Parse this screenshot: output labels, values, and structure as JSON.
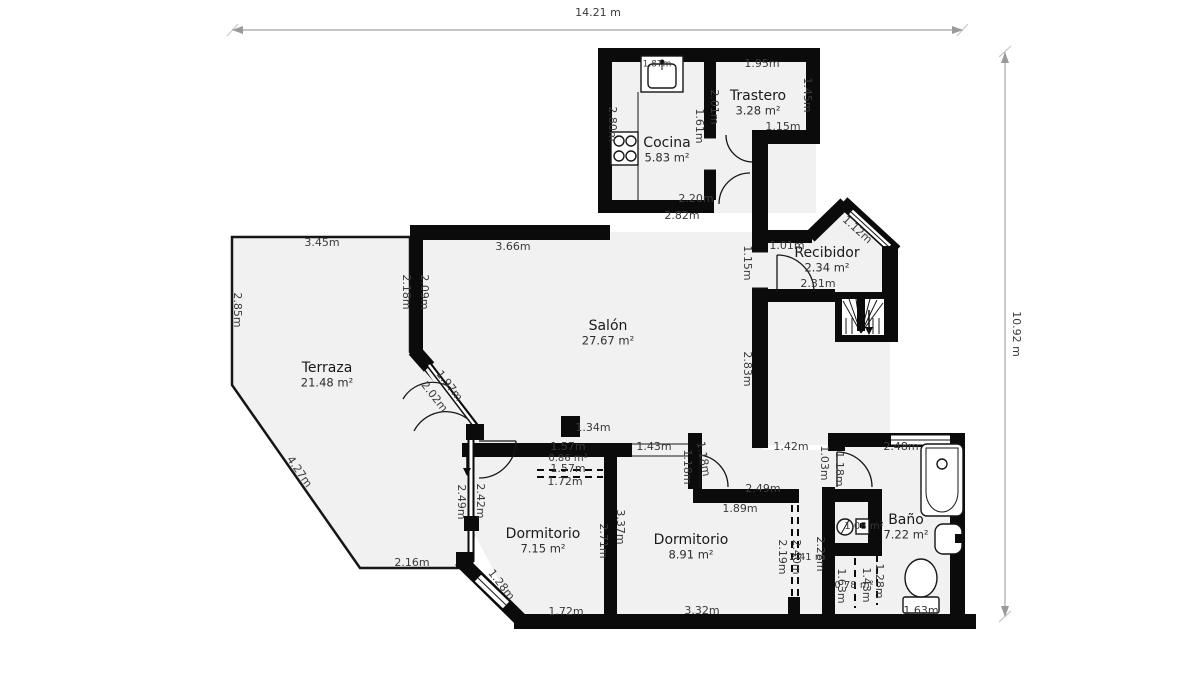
{
  "meta": {
    "plan_total_width": "14.21 m",
    "plan_total_height": "10.92 m",
    "colors": {
      "wall": "#0b0b0b",
      "room_fill": "#f1f1f1",
      "background": "#ffffff",
      "dim_text": "#3a3a3a",
      "dim_line": "#b3b3b3"
    }
  },
  "rooms": [
    {
      "name": "Cocina",
      "area": "5.83 m²",
      "x": 667,
      "y": 143
    },
    {
      "name": "Trastero",
      "area": "3.28 m²",
      "x": 758,
      "y": 96
    },
    {
      "name": "Recibidor",
      "area": "2.34 m²",
      "x": 827,
      "y": 253
    },
    {
      "name": "Salón",
      "area": "27.67 m²",
      "x": 608,
      "y": 326
    },
    {
      "name": "Terraza",
      "area": "21.48 m²",
      "x": 327,
      "y": 368
    },
    {
      "name": "Dormitorio",
      "area": "7.15 m²",
      "x": 543,
      "y": 534
    },
    {
      "name": "Dormitorio",
      "area": "8.91 m²",
      "x": 691,
      "y": 540
    },
    {
      "name": "Baño",
      "area": "7.22 m²",
      "x": 906,
      "y": 520
    }
  ],
  "labels": [
    {
      "t": "14.21 m",
      "x": 598,
      "y": 13,
      "r": 0,
      "s": 11
    },
    {
      "t": "10.92 m",
      "x": 1016,
      "y": 334,
      "r": 90,
      "s": 11
    },
    {
      "t": "1.87m",
      "x": 657,
      "y": 64,
      "r": 0,
      "s": 9
    },
    {
      "t": "1.95m",
      "x": 762,
      "y": 64,
      "r": 0,
      "s": 11
    },
    {
      "t": "1.45m",
      "x": 807,
      "y": 95,
      "r": 90,
      "s": 11
    },
    {
      "t": "1.15m",
      "x": 783,
      "y": 127,
      "r": 0,
      "s": 11
    },
    {
      "t": "2.01m",
      "x": 714,
      "y": 107,
      "r": 90,
      "s": 11
    },
    {
      "t": "1.61m",
      "x": 699,
      "y": 126,
      "r": 90,
      "s": 11
    },
    {
      "t": "2.80m",
      "x": 612,
      "y": 124,
      "r": 90,
      "s": 11
    },
    {
      "t": "2.20m",
      "x": 696,
      "y": 199,
      "r": 0,
      "s": 11
    },
    {
      "t": "2.82m",
      "x": 682,
      "y": 216,
      "r": 0,
      "s": 11
    },
    {
      "t": "1.01m",
      "x": 787,
      "y": 246,
      "r": 0,
      "s": 11
    },
    {
      "t": "1.12m",
      "x": 857,
      "y": 230,
      "r": 42,
      "s": 11
    },
    {
      "t": "2.31m",
      "x": 818,
      "y": 284,
      "r": 0,
      "s": 11
    },
    {
      "t": "1.15m",
      "x": 747,
      "y": 263,
      "r": 90,
      "s": 11
    },
    {
      "t": "2.83m",
      "x": 747,
      "y": 369,
      "r": 90,
      "s": 11
    },
    {
      "t": "3.66m",
      "x": 513,
      "y": 247,
      "r": 0,
      "s": 11
    },
    {
      "t": "2.18m",
      "x": 406,
      "y": 292,
      "r": 90,
      "s": 11
    },
    {
      "t": "2.09m",
      "x": 424,
      "y": 292,
      "r": 90,
      "s": 11
    },
    {
      "t": "3.45m",
      "x": 322,
      "y": 243,
      "r": 0,
      "s": 11
    },
    {
      "t": "2.85m",
      "x": 237,
      "y": 310,
      "r": 90,
      "s": 11
    },
    {
      "t": "4.27m",
      "x": 299,
      "y": 472,
      "r": 55,
      "s": 11
    },
    {
      "t": "2.16m",
      "x": 412,
      "y": 563,
      "r": 0,
      "s": 11
    },
    {
      "t": "1.97m",
      "x": 449,
      "y": 386,
      "r": 52,
      "s": 11
    },
    {
      "t": "2.02m",
      "x": 434,
      "y": 397,
      "r": 52,
      "s": 11
    },
    {
      "t": "2.49m",
      "x": 461,
      "y": 502,
      "r": 90,
      "s": 11
    },
    {
      "t": "2.42m",
      "x": 480,
      "y": 501,
      "r": 90,
      "s": 11
    },
    {
      "t": "1.34m",
      "x": 593,
      "y": 428,
      "r": 0,
      "s": 11
    },
    {
      "t": "1.57m",
      "x": 568,
      "y": 447,
      "r": 0,
      "s": 11
    },
    {
      "t": "0.86 m²",
      "x": 568,
      "y": 458,
      "r": 0,
      "s": 10
    },
    {
      "t": "1.57m",
      "x": 568,
      "y": 469,
      "r": 0,
      "s": 11
    },
    {
      "t": "1.72m",
      "x": 565,
      "y": 482,
      "r": 0,
      "s": 11
    },
    {
      "t": "1.43m",
      "x": 654,
      "y": 447,
      "r": 0,
      "s": 11
    },
    {
      "t": "1.18m",
      "x": 687,
      "y": 467,
      "r": 90,
      "s": 11
    },
    {
      "t": "1.18m",
      "x": 703,
      "y": 459,
      "r": 80,
      "s": 11
    },
    {
      "t": "2.49m",
      "x": 763,
      "y": 489,
      "r": 0,
      "s": 11
    },
    {
      "t": "1.89m",
      "x": 740,
      "y": 509,
      "r": 0,
      "s": 11
    },
    {
      "t": "1.42m",
      "x": 791,
      "y": 447,
      "r": 0,
      "s": 11
    },
    {
      "t": "1.03m",
      "x": 824,
      "y": 463,
      "r": 90,
      "s": 11
    },
    {
      "t": "1.18m",
      "x": 839,
      "y": 469,
      "r": 90,
      "s": 11
    },
    {
      "t": "2.48m",
      "x": 901,
      "y": 447,
      "r": 0,
      "s": 11
    },
    {
      "t": "1.72m",
      "x": 566,
      "y": 612,
      "r": 0,
      "s": 11
    },
    {
      "t": "3.32m",
      "x": 702,
      "y": 611,
      "r": 0,
      "s": 11
    },
    {
      "t": "1.28m",
      "x": 501,
      "y": 585,
      "r": 52,
      "s": 11
    },
    {
      "t": "2.71m",
      "x": 603,
      "y": 541,
      "r": 90,
      "s": 11
    },
    {
      "t": "3.37m",
      "x": 620,
      "y": 527,
      "r": 90,
      "s": 11
    },
    {
      "t": "2.19m",
      "x": 782,
      "y": 557,
      "r": 90,
      "s": 11
    },
    {
      "t": "2.40m",
      "x": 796,
      "y": 557,
      "r": 90,
      "s": 11
    },
    {
      "t": "2.41 m",
      "x": 807,
      "y": 557,
      "r": 0,
      "s": 10
    },
    {
      "t": "2.28m",
      "x": 820,
      "y": 554,
      "r": 90,
      "s": 11
    },
    {
      "t": "1.63m",
      "x": 841,
      "y": 586,
      "r": 90,
      "s": 11
    },
    {
      "t": "0.78 m²",
      "x": 854,
      "y": 585,
      "r": 0,
      "s": 10
    },
    {
      "t": "1.43m",
      "x": 866,
      "y": 585,
      "r": 90,
      "s": 11
    },
    {
      "t": "1.28m",
      "x": 879,
      "y": 581,
      "r": 90,
      "s": 11
    },
    {
      "t": "1.63m",
      "x": 921,
      "y": 611,
      "r": 0,
      "s": 11
    },
    {
      "t": "1.08 m²",
      "x": 864,
      "y": 526,
      "r": 0,
      "s": 10
    }
  ]
}
